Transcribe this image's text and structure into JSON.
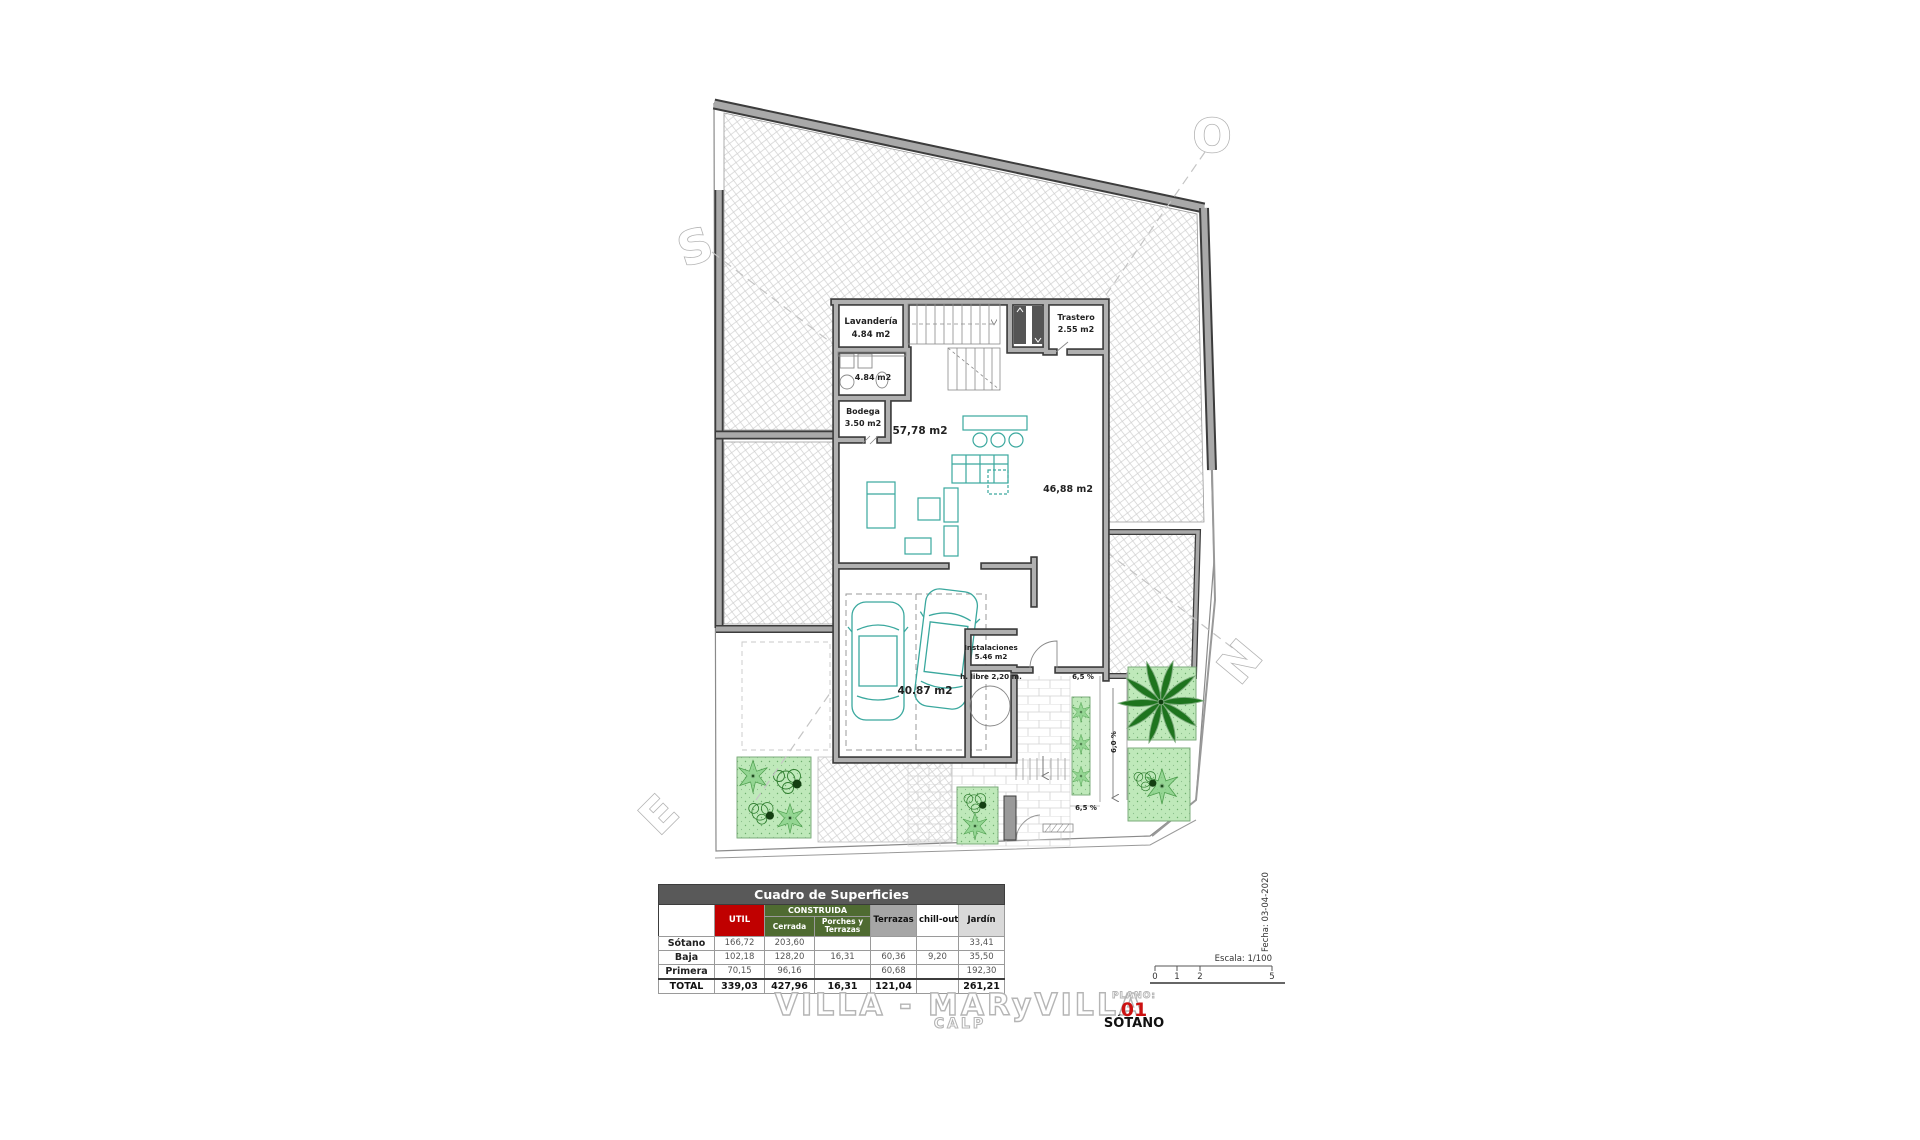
{
  "document": {
    "title": "VILLA - MARyVILLA",
    "subtitle": "CALP",
    "plano_label": "PLANO:",
    "plano_number": "01",
    "plano_name": "SÓTANO",
    "scale_label": "Escala: 1/100",
    "date_label": "Fecha: 03-04-2020",
    "scale_ticks": [
      "0",
      "1",
      "2",
      "5"
    ]
  },
  "compass": {
    "south": "S",
    "west": "O",
    "north": "N",
    "east": "E"
  },
  "plan_labels": {
    "lavanderia_name": "Lavandería",
    "lavanderia_area": "4.84 m2",
    "bath_area": "4.84 m2",
    "trastero_name": "Trastero",
    "trastero_area": "2.55 m2",
    "bodega_name": "Bodega",
    "bodega_area": "3.50 m2",
    "living_area": "57,78 m2",
    "hall_area": "46,88 m2",
    "garage_area": "40.87 m2",
    "instalaciones_name": "Instalaciones",
    "instalaciones_area": "5.46 m2",
    "clearance": "h. libre 2,20 m.",
    "ramp_slope_top": "6,5 %",
    "ramp_slope_bottom": "6,5 %",
    "ramp_slope_side": "6,0 %"
  },
  "table": {
    "title": "Cuadro de Superficies",
    "col_util": "UTIL",
    "col_construida": "CONSTRUIDA",
    "col_cerrada": "Cerrada",
    "col_porches": "Porches y Terrazas",
    "col_terrazas": "Terrazas",
    "col_chillout": "chill-out",
    "col_jardin": "Jardín",
    "rows": [
      {
        "name": "Sótano",
        "util": "166,72",
        "cerrada": "203,60",
        "porches": "",
        "terrazas": "",
        "chillout": "",
        "jardin": "33,41"
      },
      {
        "name": "Baja",
        "util": "102,18",
        "cerrada": "128,20",
        "porches": "16,31",
        "terrazas": "60,36",
        "chillout": "9,20",
        "jardin": "35,50"
      },
      {
        "name": "Primera",
        "util": "70,15",
        "cerrada": "96,16",
        "porches": "",
        "terrazas": "60,68",
        "chillout": "",
        "jardin": "192,30"
      },
      {
        "name": "TOTAL",
        "util": "339,03",
        "cerrada": "427,96",
        "porches": "16,31",
        "terrazas": "121,04",
        "chillout": "",
        "jardin": "261,21"
      }
    ]
  },
  "colors": {
    "wall_gray": "#a9a9a9",
    "furniture_teal": "#3aa89e",
    "garden_green": "#bfe9ba",
    "table_header_gray": "#595959",
    "util_red": "#c00000",
    "construida_green": "#4f6b31",
    "plano_red": "#cc1111"
  }
}
